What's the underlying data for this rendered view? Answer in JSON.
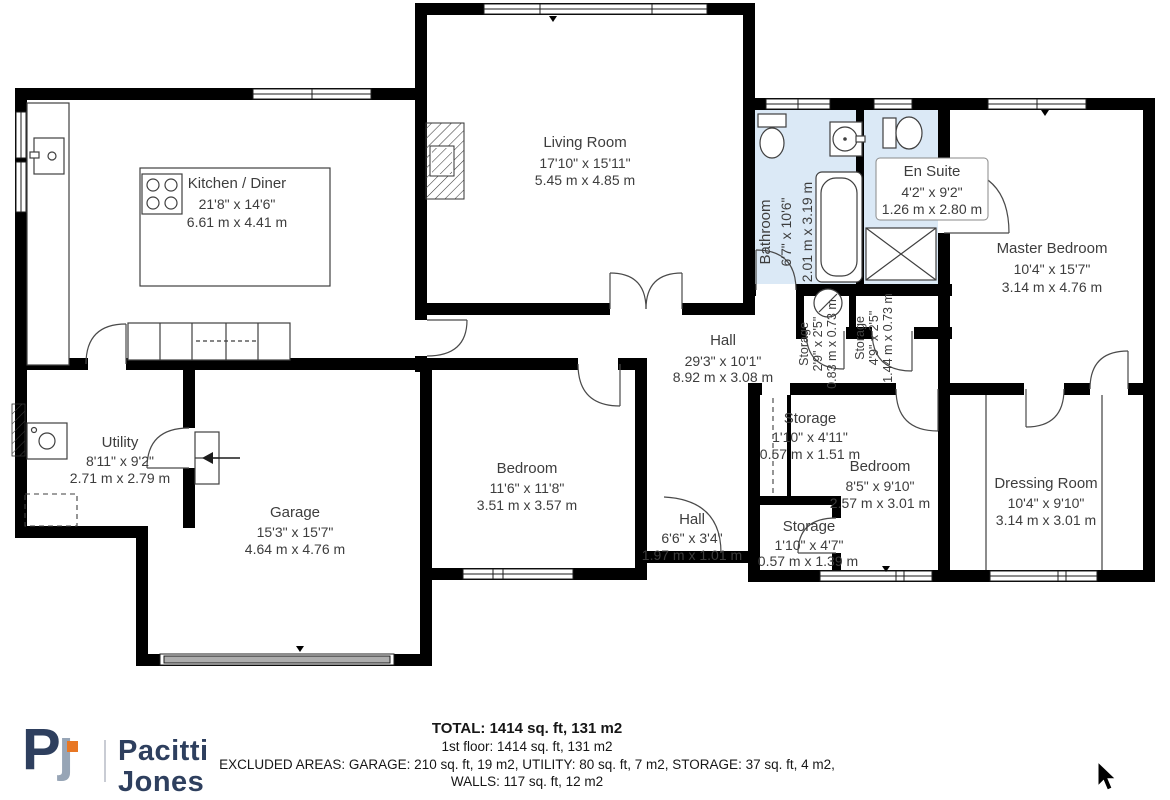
{
  "plan": {
    "rooms": {
      "kitchen": {
        "name": "Kitchen / Diner",
        "imperial": "21'8\" x 14'6\"",
        "metric": "6.61 m x 4.41 m"
      },
      "living": {
        "name": "Living Room",
        "imperial": "17'10\" x 15'11\"",
        "metric": "5.45 m x 4.85 m"
      },
      "bathroom": {
        "name": "Bathroom",
        "imperial": "6'7\" x 10'6\"",
        "metric": "2.01 m x 3.19 m"
      },
      "ensuite": {
        "name": "En Suite",
        "imperial": "4'2\" x 9'2\"",
        "metric": "1.26 m x 2.80 m"
      },
      "master": {
        "name": "Master Bedroom",
        "imperial": "10'4\" x 15'7\"",
        "metric": "3.14 m x 4.76 m"
      },
      "hall": {
        "name": "Hall",
        "imperial": "29'3\" x 10'1\"",
        "metric": "8.92 m x 3.08 m"
      },
      "storage_bath": {
        "name": "Storage",
        "imperial": "2'9\" x 2'5\"",
        "metric": "0.83 m x 0.73 m"
      },
      "storage_ensuite": {
        "name": "Storage",
        "imperial": "4'9\" x 2'5\"",
        "metric": "1.44 m x 0.73 m"
      },
      "utility": {
        "name": "Utility",
        "imperial": "8'11\" x 9'2\"",
        "metric": "2.71 m x 2.79 m"
      },
      "garage": {
        "name": "Garage",
        "imperial": "15'3\" x 15'7\"",
        "metric": "4.64 m x 4.76 m"
      },
      "bedroom_mid": {
        "name": "Bedroom",
        "imperial": "11'6\" x 11'8\"",
        "metric": "3.51 m x 3.57 m"
      },
      "hall_small": {
        "name": "Hall",
        "imperial": "6'6\" x 3'4\"",
        "metric": "1.97 m x 1.01 m"
      },
      "storage_tall": {
        "name": "Storage",
        "imperial": "1'10\" x 4'11\"",
        "metric": "0.57 m x 1.51 m"
      },
      "bedroom_right": {
        "name": "Bedroom",
        "imperial": "8'5\" x 9'10\"",
        "metric": "2.57 m x 3.01 m"
      },
      "storage_low": {
        "name": "Storage",
        "imperial": "1'10\" x 4'7\"",
        "metric": "0.57 m x 1.39 m"
      },
      "dressing": {
        "name": "Dressing Room",
        "imperial": "10'4\" x 9'10\"",
        "metric": "3.14 m x 3.01 m"
      }
    }
  },
  "summary": {
    "total": "TOTAL: 1414 sq. ft, 131 m2",
    "floor": "1st floor: 1414 sq. ft, 131 m2",
    "excluded": "EXCLUDED AREAS: GARAGE: 210 sq. ft, 19 m2, UTILITY: 80 sq. ft, 7 m2, STORAGE: 37 sq. ft, 4 m2,",
    "walls": "WALLS: 117 sq. ft, 12 m2"
  },
  "logo": {
    "monogram_p": "P",
    "monogram_j": "ȷ",
    "name_top": "Pacitti",
    "name_bottom": "Jones"
  },
  "colors": {
    "wet_room_fill": "#dbe9f6",
    "wall": "#000000",
    "logo_navy": "#2e3f5e",
    "logo_gray": "#97a5b6",
    "logo_orange": "#e87724"
  }
}
